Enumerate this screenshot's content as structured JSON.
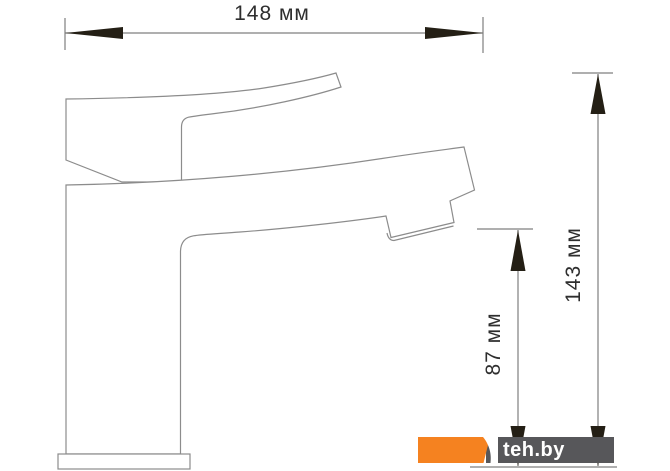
{
  "drawing": {
    "subject": "single-lever basin faucet, side-view dimension drawing",
    "unit": "мм",
    "dimensions": {
      "width": {
        "label": "148 мм",
        "value_mm": 148
      },
      "total_height": {
        "label": "143 мм",
        "value_mm": 143
      },
      "spout_height": {
        "label": "87 мм",
        "value_mm": 87
      }
    }
  },
  "watermark": {
    "text": "teh.by",
    "orange": "#F58220",
    "gray": "#57575A",
    "text_color": "#FFFFFF"
  },
  "style": {
    "background": "#FFFFFF",
    "outline_color": "#8C8C8C",
    "dimension_line_color": "#7F7F7F",
    "arrow_color": "#241F15",
    "text_color": "#2E2E2E"
  }
}
